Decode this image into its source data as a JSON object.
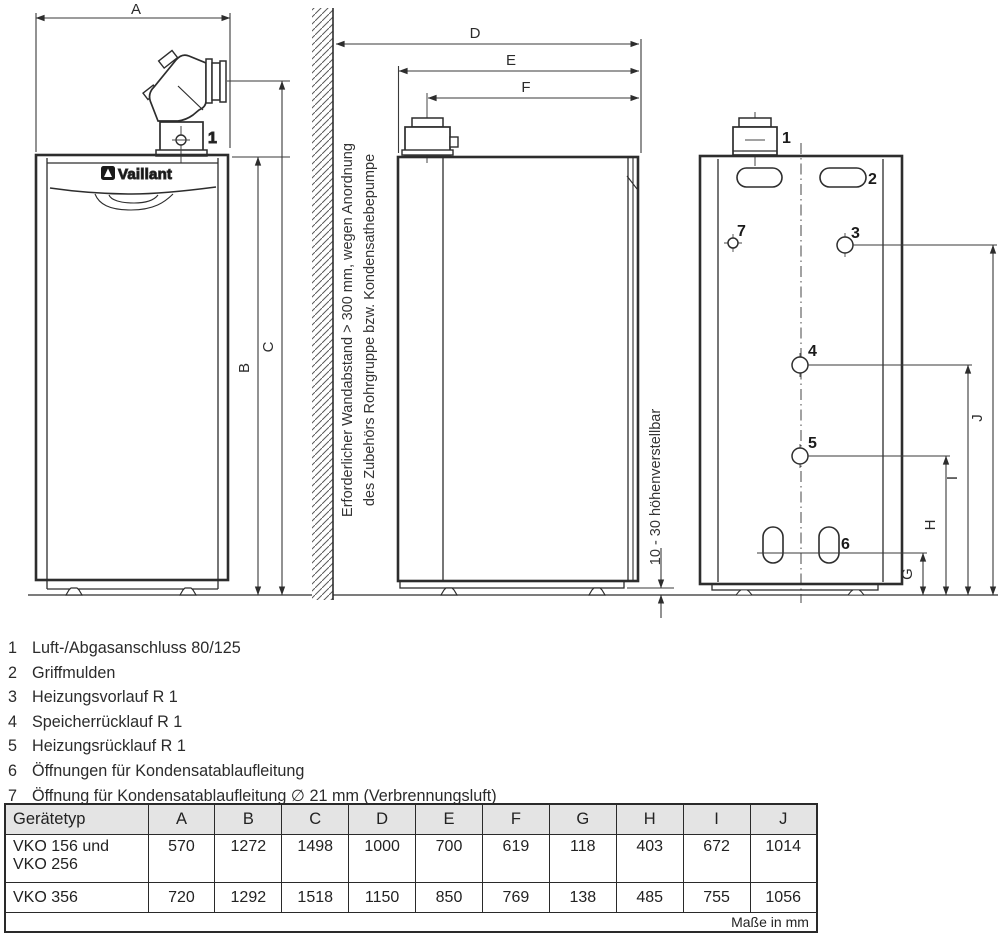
{
  "drawing": {
    "brand": "Vaillant",
    "dims": {
      "A": "A",
      "B": "B",
      "C": "C",
      "D": "D",
      "E": "E",
      "F": "F",
      "G": "G",
      "H": "H",
      "I": "I",
      "J": "J"
    },
    "callouts": {
      "c1": "1",
      "c2": "2",
      "c3": "3",
      "c4": "4",
      "c5": "5",
      "c6": "6",
      "c7": "7"
    },
    "wall_note": {
      "line1": "Erforderlicher Wandabstand > 300 mm, wegen Anordnung",
      "line2": "des Zubehörs Rohrgruppe bzw. Kondensathebepumpe"
    },
    "height_note": "10 - 30 höhenverstellbar"
  },
  "legend": {
    "items": [
      {
        "num": "1",
        "text": "Luft-/Abgasanschluss 80/125"
      },
      {
        "num": "2",
        "text": "Griffmulden"
      },
      {
        "num": "3",
        "text": "Heizungsvorlauf R 1"
      },
      {
        "num": "4",
        "text": "Speicherrücklauf R 1"
      },
      {
        "num": "5",
        "text": "Heizungsrücklauf R 1"
      },
      {
        "num": "6",
        "text": "Öffnungen für Kondensatablaufleitung"
      },
      {
        "num": "7",
        "text": "Öffnung für Kondensatablaufleitung ∅ 21 mm (Verbrennungsluft)"
      }
    ]
  },
  "table": {
    "headers": [
      "Gerätetyp",
      "A",
      "B",
      "C",
      "D",
      "E",
      "F",
      "G",
      "H",
      "I",
      "J"
    ],
    "rows": [
      {
        "type": "VKO 156 und\nVKO 256",
        "values": [
          "570",
          "1272",
          "1498",
          "1000",
          "700",
          "619",
          "118",
          "403",
          "672",
          "1014"
        ]
      },
      {
        "type": "VKO 356",
        "values": [
          "720",
          "1292",
          "1518",
          "1150",
          "850",
          "769",
          "138",
          "485",
          "755",
          "1056"
        ]
      }
    ],
    "footer": "Maße in mm"
  }
}
